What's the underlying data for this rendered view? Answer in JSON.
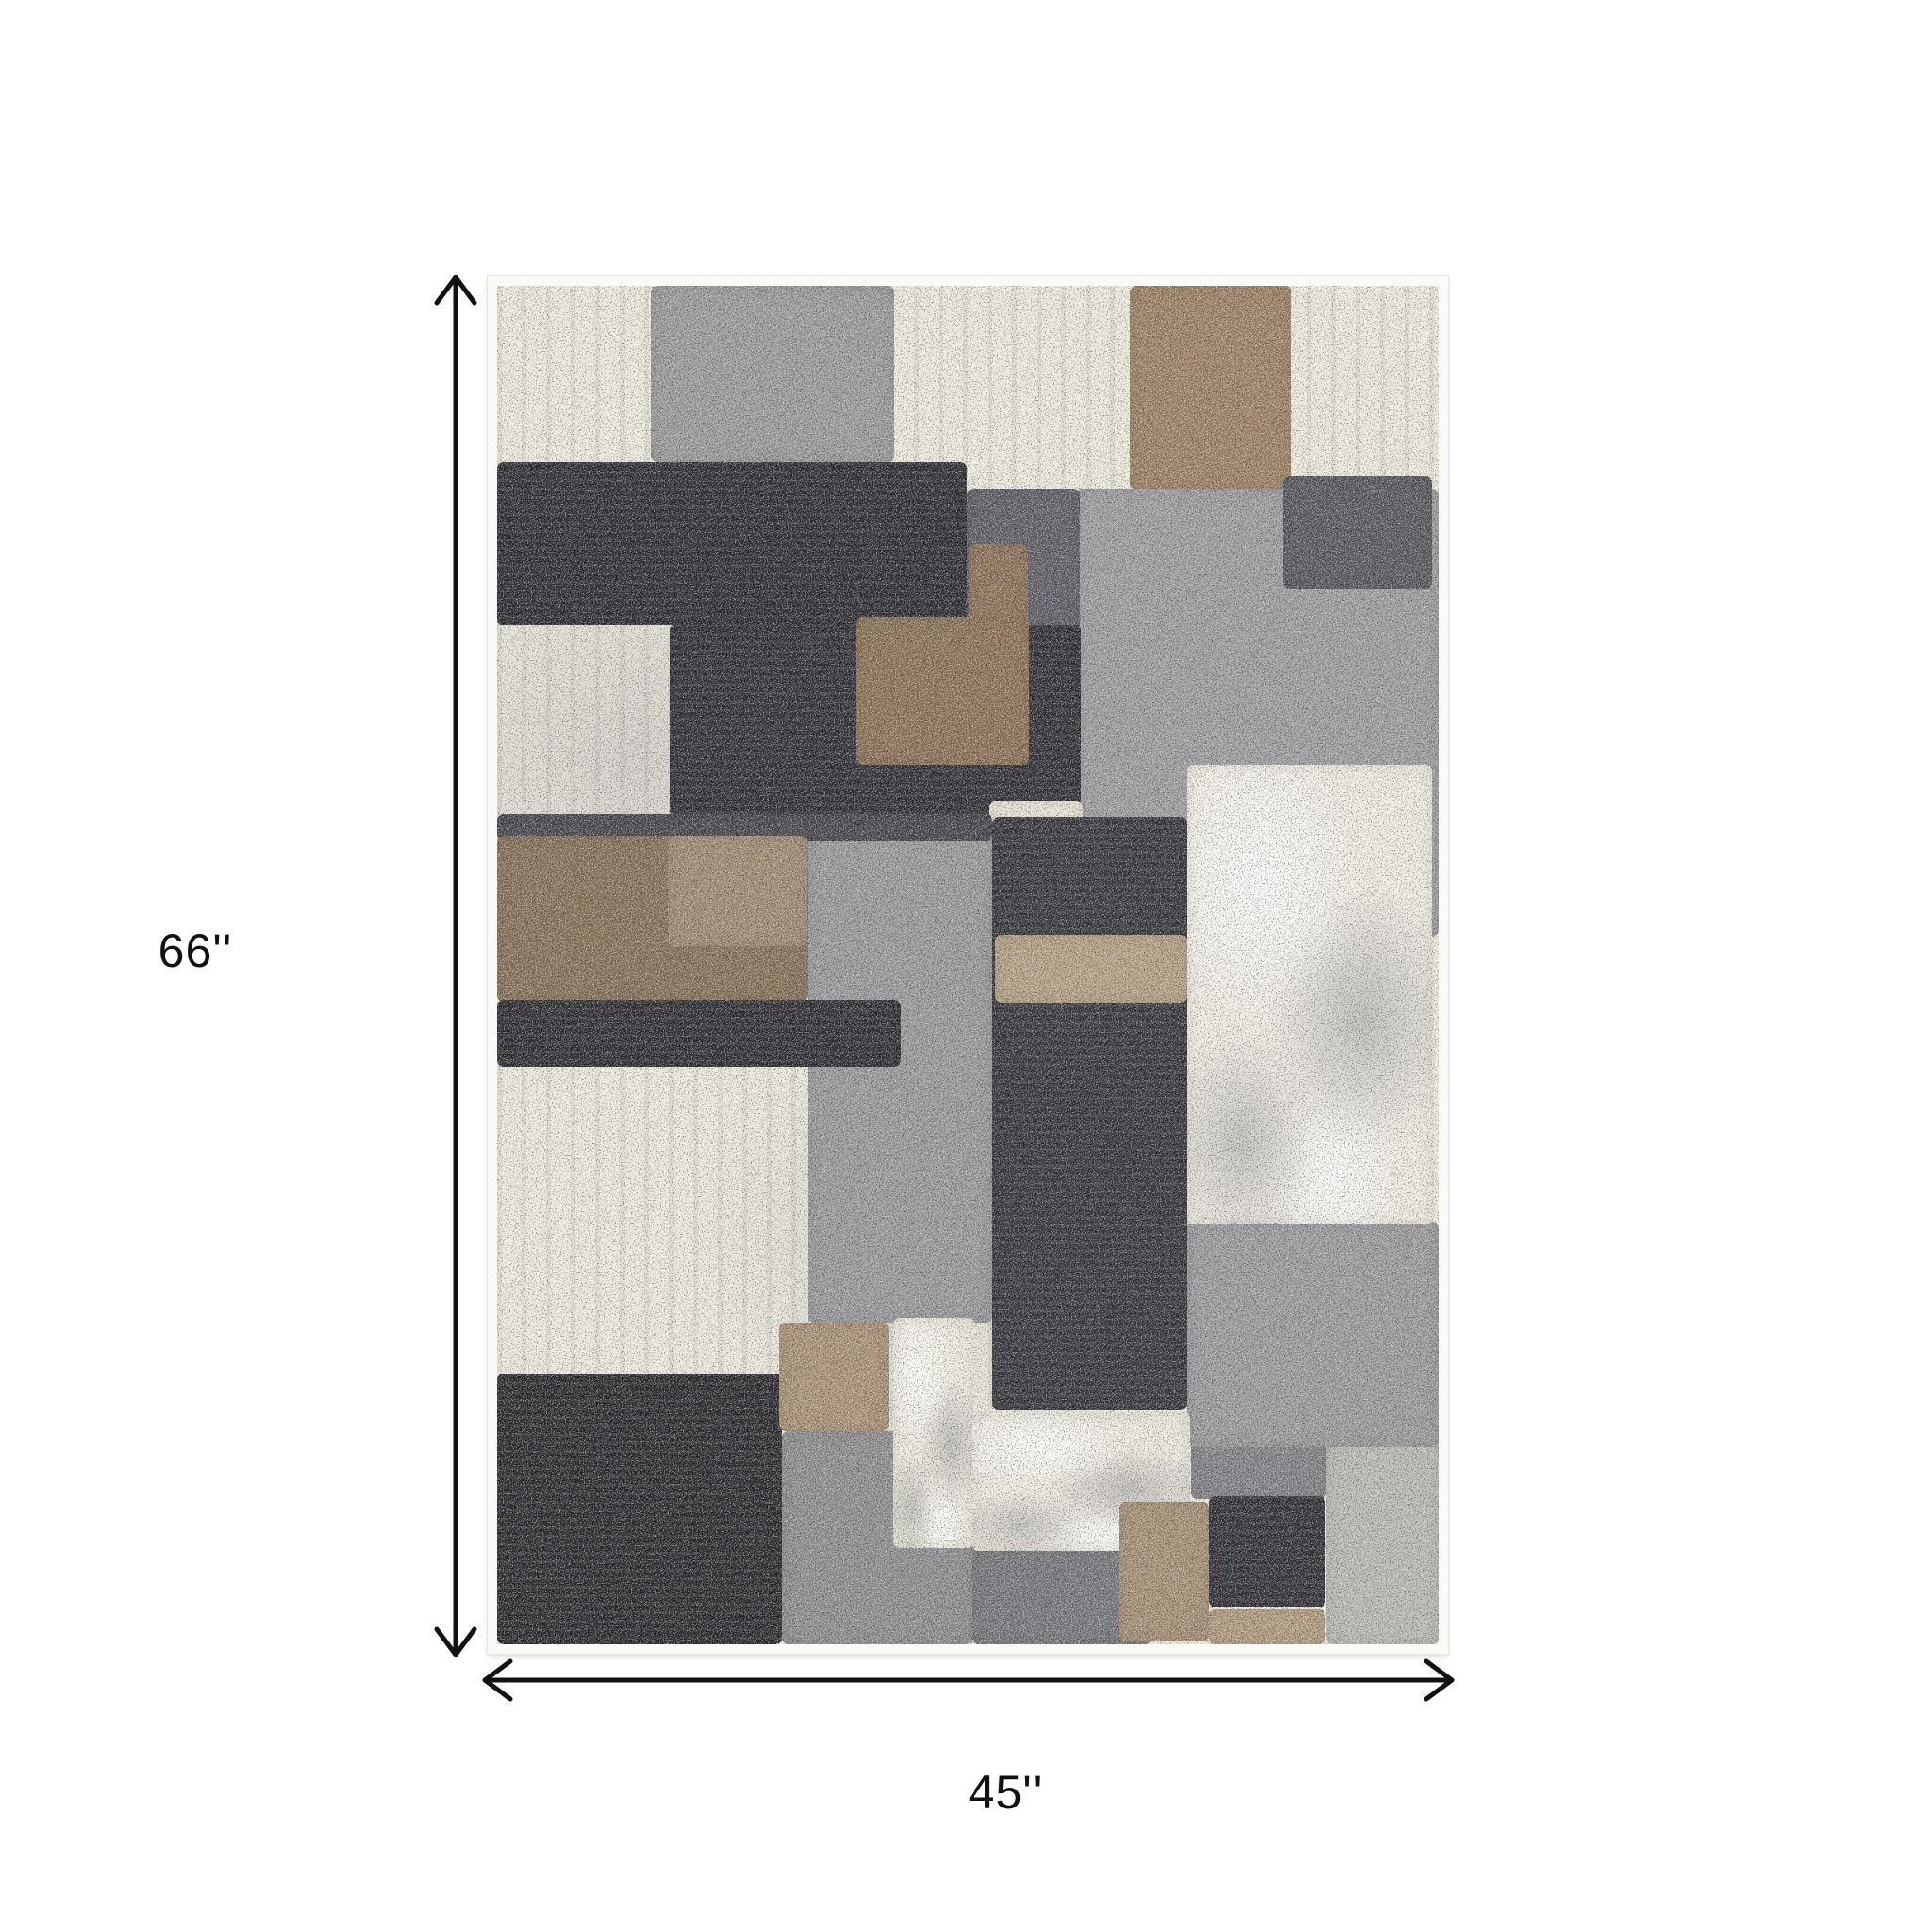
{
  "page": {
    "background": "#ffffff"
  },
  "dimensions": {
    "height_label": "66''",
    "width_label": "45''",
    "arrow_color": "#111111"
  },
  "rug": {
    "description": "abstract patchwork area rug in charcoal, gray, cream and brown",
    "border_color": "#fafaf7",
    "base_color": "#edeade",
    "patches": [
      {
        "name": "patch-concrete-top",
        "x": 16.3,
        "y": 0,
        "w": 25.9,
        "h": 13.0,
        "color": "#999a9a"
      },
      {
        "name": "patch-brown-top-right",
        "x": 67.2,
        "y": 0,
        "w": 17.2,
        "h": 15.0,
        "color": "#9d8164"
      },
      {
        "name": "patch-concrete-right",
        "x": 61.4,
        "y": 14.9,
        "w": 38.6,
        "h": 33.0,
        "color": "#9c9c9e"
      },
      {
        "name": "patch-concrete-middle",
        "x": 33.0,
        "y": 39.1,
        "w": 19.6,
        "h": 37.2,
        "color": "#98989a"
      },
      {
        "name": "patch-concrete-bottom-right-outer",
        "x": 88.1,
        "y": 82.9,
        "w": 11.9,
        "h": 17.1,
        "color": "#b9b8b4"
      },
      {
        "name": "patch-gray-bottom-middle",
        "x": 30.3,
        "y": 84.3,
        "w": 20.3,
        "h": 15.7,
        "color": "#8d8d90"
      },
      {
        "name": "patch-gray-bottom-center",
        "x": 50.4,
        "y": 92.9,
        "w": 19.1,
        "h": 7.1,
        "color": "#76767a"
      },
      {
        "name": "patch-gray-bottom-square",
        "x": 73.7,
        "y": 81.0,
        "w": 14.4,
        "h": 8.3,
        "color": "#818185"
      },
      {
        "name": "patch-concrete-right-lower",
        "x": 73.2,
        "y": 68.9,
        "w": 26.8,
        "h": 16.6,
        "color": "#9a9a9c"
      },
      {
        "name": "patch-dark-gray-right",
        "x": 83.5,
        "y": 14.0,
        "w": 15.8,
        "h": 8.3,
        "color": "#57575d"
      },
      {
        "name": "patch-black-bar-top",
        "x": 0,
        "y": 13.0,
        "w": 49.9,
        "h": 12.0,
        "color": "#2b2b2f",
        "cls": "dark"
      },
      {
        "name": "patch-gray-bar-extension",
        "x": 49.9,
        "y": 14.9,
        "w": 12.0,
        "h": 10.5,
        "color": "#5d5d63"
      },
      {
        "name": "patch-black-block-center",
        "x": 18.3,
        "y": 24.9,
        "w": 43.7,
        "h": 14.2,
        "color": "#2c2c31",
        "cls": "dark"
      },
      {
        "name": "patch-cream-strip-center",
        "x": 52.2,
        "y": 37.9,
        "w": 10.0,
        "h": 1.6,
        "color": "#e9e6da"
      },
      {
        "name": "patch-dark-strip-left",
        "x": 0,
        "y": 38.9,
        "w": 52.6,
        "h": 1.9,
        "color": "#47474d"
      },
      {
        "name": "patch-brown-center-arm",
        "x": 50.1,
        "y": 19.0,
        "w": 6.3,
        "h": 6.2,
        "color": "#8c7157"
      },
      {
        "name": "patch-brown-center",
        "x": 38.1,
        "y": 24.4,
        "w": 18.4,
        "h": 10.9,
        "color": "#8c7157"
      },
      {
        "name": "patch-tall-dark-block",
        "x": 52.6,
        "y": 39.1,
        "w": 20.6,
        "h": 43.7,
        "color": "#333338",
        "cls": "dark"
      },
      {
        "name": "patch-tan-strip-inset",
        "x": 52.9,
        "y": 47.8,
        "w": 20.3,
        "h": 5.0,
        "color": "#b3a084"
      },
      {
        "name": "patch-brown-block-left",
        "x": 0,
        "y": 40.5,
        "w": 33.0,
        "h": 12.2,
        "color": "#877057"
      },
      {
        "name": "patch-tan-inset-left",
        "x": 18.1,
        "y": 40.5,
        "w": 14.8,
        "h": 8.1,
        "color": "#a28a72"
      },
      {
        "name": "patch-black-bar-mid",
        "x": 0,
        "y": 52.6,
        "w": 42.9,
        "h": 4.9,
        "color": "#2b2b2f",
        "cls": "dark"
      },
      {
        "name": "patch-cream-right-large",
        "x": 73.2,
        "y": 35.3,
        "w": 26.1,
        "h": 33.8,
        "color": "#efece2",
        "cls": "marble"
      },
      {
        "name": "patch-black-block-bottom-left",
        "x": 0,
        "y": 80.1,
        "w": 30.3,
        "h": 19.9,
        "color": "#27272b",
        "cls": "dark"
      },
      {
        "name": "patch-tan-square-bottom",
        "x": 30.0,
        "y": 76.3,
        "w": 11.6,
        "h": 8.0,
        "color": "#aa9176"
      },
      {
        "name": "patch-cream-strip-bottom",
        "x": 42.1,
        "y": 76.0,
        "w": 8.5,
        "h": 16.9,
        "color": "#eeebdf",
        "cls": "marble"
      },
      {
        "name": "patch-cream-bottom-center",
        "x": 50.4,
        "y": 82.9,
        "w": 23.1,
        "h": 10.2,
        "color": "#edeade",
        "cls": "marble"
      },
      {
        "name": "patch-tan-vertical-bottom",
        "x": 66.0,
        "y": 89.5,
        "w": 9.7,
        "h": 10.3,
        "color": "#a68e74"
      },
      {
        "name": "patch-black-square-bottom",
        "x": 75.7,
        "y": 89.1,
        "w": 12.3,
        "h": 8.2,
        "color": "#2e2e33",
        "cls": "dark"
      },
      {
        "name": "patch-tan-strip-bottom-right",
        "x": 75.7,
        "y": 97.4,
        "w": 12.3,
        "h": 2.6,
        "color": "#b29c80"
      }
    ]
  }
}
